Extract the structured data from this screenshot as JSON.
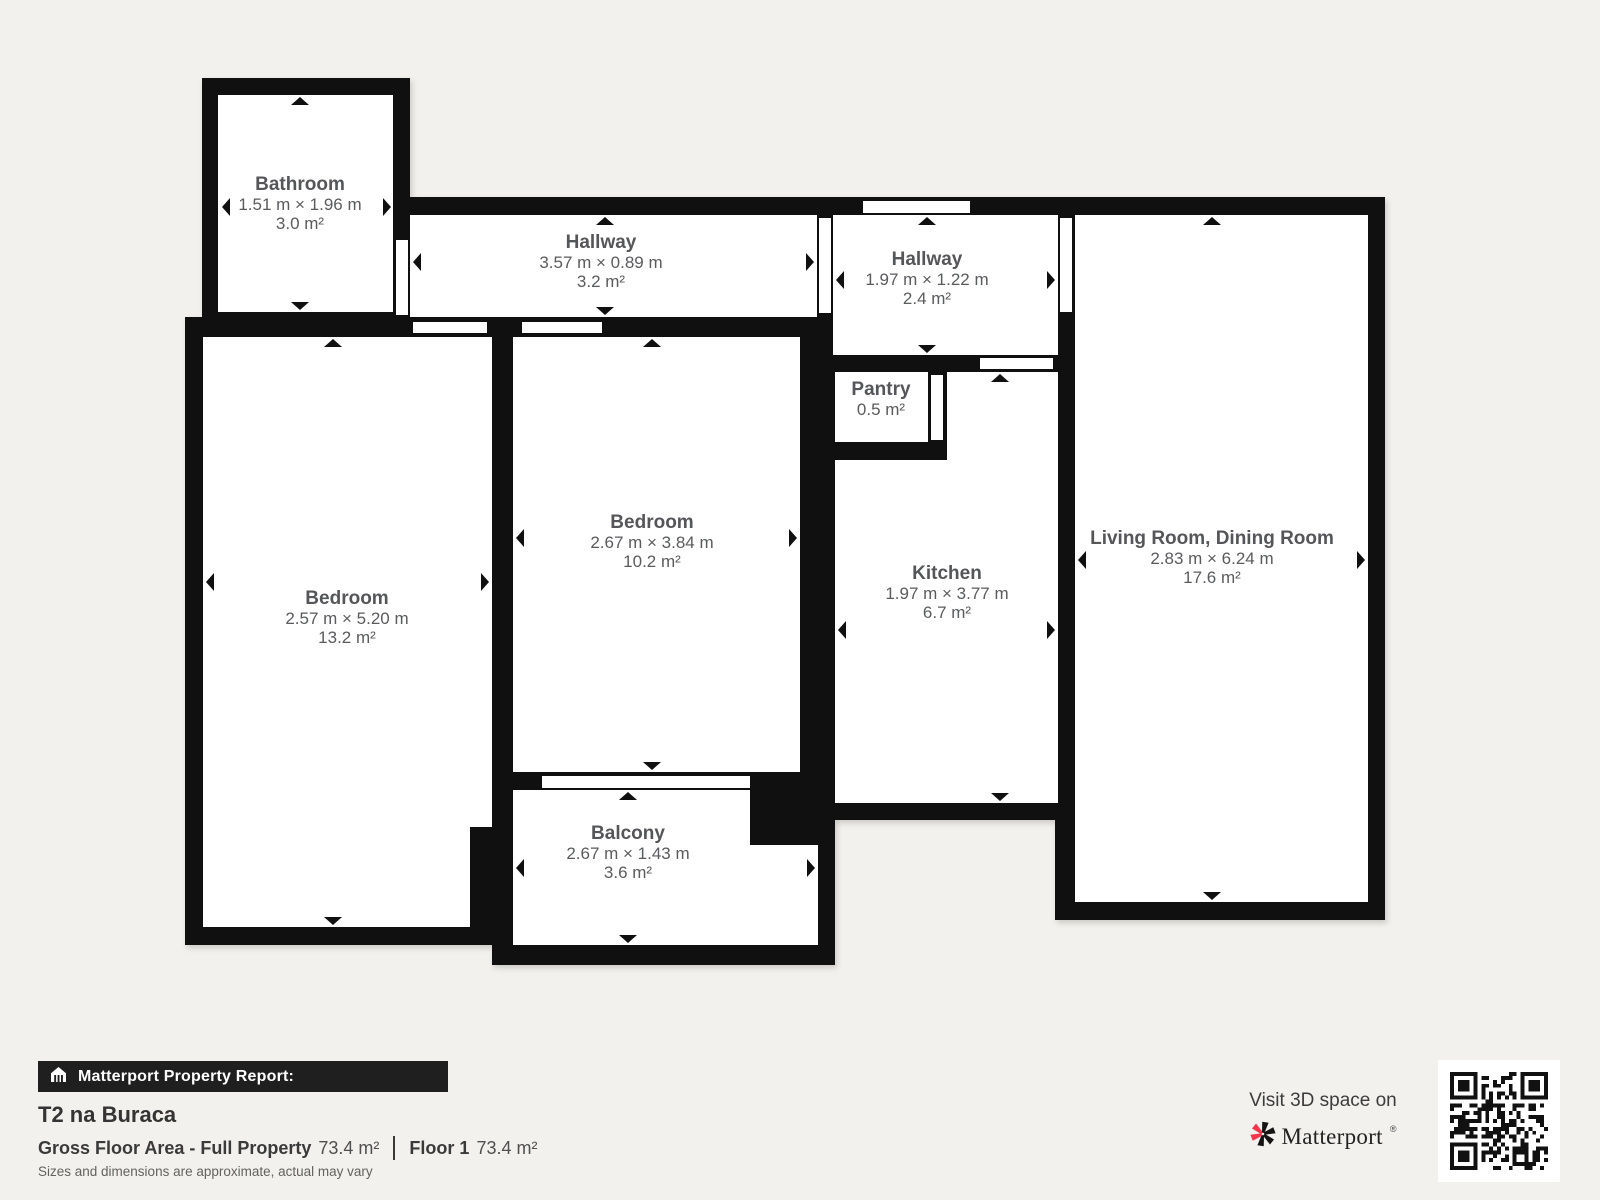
{
  "floorplan": {
    "rooms": [
      {
        "name": "Bathroom",
        "dims": "1.51 m × 1.96 m",
        "area": "3.0 m²"
      },
      {
        "name": "Hallway",
        "dims": "3.57 m × 0.89 m",
        "area": "3.2 m²"
      },
      {
        "name": "Hallway",
        "dims": "1.97 m × 1.22 m",
        "area": "2.4 m²"
      },
      {
        "name": "Pantry",
        "dims": "",
        "area": "0.5 m²"
      },
      {
        "name": "Bedroom",
        "dims": "2.57 m × 5.20 m",
        "area": "13.2 m²"
      },
      {
        "name": "Bedroom",
        "dims": "2.67 m × 3.84 m",
        "area": "10.2 m²"
      },
      {
        "name": "Kitchen",
        "dims": "1.97 m × 3.77 m",
        "area": "6.7 m²"
      },
      {
        "name": "Living Room, Dining Room",
        "dims": "2.83 m × 6.24 m",
        "area": "17.6 m²"
      },
      {
        "name": "Balcony",
        "dims": "2.67 m × 1.43 m",
        "area": "3.6 m²"
      }
    ]
  },
  "report": {
    "bar_label": "Matterport Property Report:",
    "property_name": "T2 na Buraca",
    "gross_label": "Gross Floor Area - Full Property",
    "gross_value": "73.4 m²",
    "floor_label": "Floor 1",
    "floor_value": "73.4 m²",
    "disclaimer": "Sizes and dimensions are approximate, actual may vary"
  },
  "promo": {
    "visit_text": "Visit 3D space on",
    "brand": "Matterport",
    "brand_mark": "®"
  },
  "colors": {
    "wall": "#101010",
    "room": "#ffffff",
    "background": "#f2f1ee",
    "label_gray": "#57585a",
    "brand_pink": "#f4364c"
  }
}
